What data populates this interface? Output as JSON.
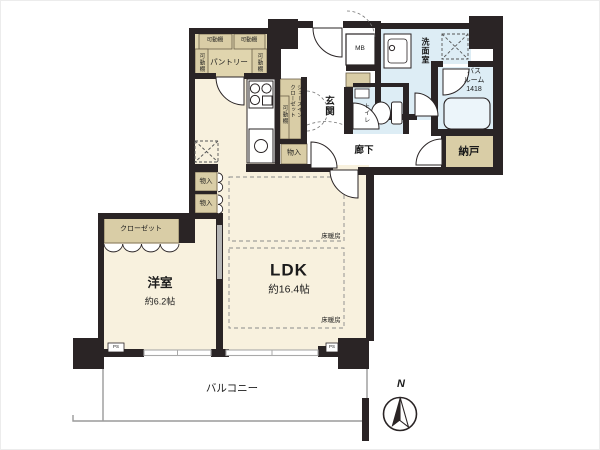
{
  "plan": {
    "rooms": {
      "ldk": {
        "name": "LDK",
        "size": "約16.4帖"
      },
      "western_room": {
        "name": "洋室",
        "size": "約6.2帖"
      },
      "pantry": {
        "name": "パントリー"
      },
      "entrance": {
        "name": "玄関"
      },
      "hallway": {
        "name": "廊下"
      },
      "washroom": {
        "name": "洗面室"
      },
      "toilet": {
        "name": "トイレ"
      },
      "bathroom": {
        "line1": "バス",
        "line2": "ルーム",
        "line3": "1418"
      },
      "storage_room": {
        "name": "納戸"
      },
      "balcony": {
        "name": "バルコニー"
      },
      "closet": {
        "name": "クローゼット"
      },
      "shoes_in_closet": {
        "line1": "シューズイン",
        "line2": "クローゼット"
      }
    },
    "labels": {
      "movable_shelf": "可動棚",
      "storage": "物入",
      "floor_heating": "床暖房",
      "meter_box": "MB",
      "pipe_space": "PS",
      "north": "N"
    },
    "colors": {
      "wall": "#2a2425",
      "floor": "#f8f1de",
      "storage_tan": "#d9cda6",
      "wet_area": "#ddedf5",
      "bathtub": "#ecf5fa",
      "window": "#a9a9a9",
      "sliding_door": "#b5b5b5"
    },
    "icons": [
      "gas-stove",
      "kitchen-sink",
      "wash-basin",
      "toilet",
      "bathtub",
      "washer-space",
      "refrigerator-space",
      "compass-rose"
    ]
  }
}
